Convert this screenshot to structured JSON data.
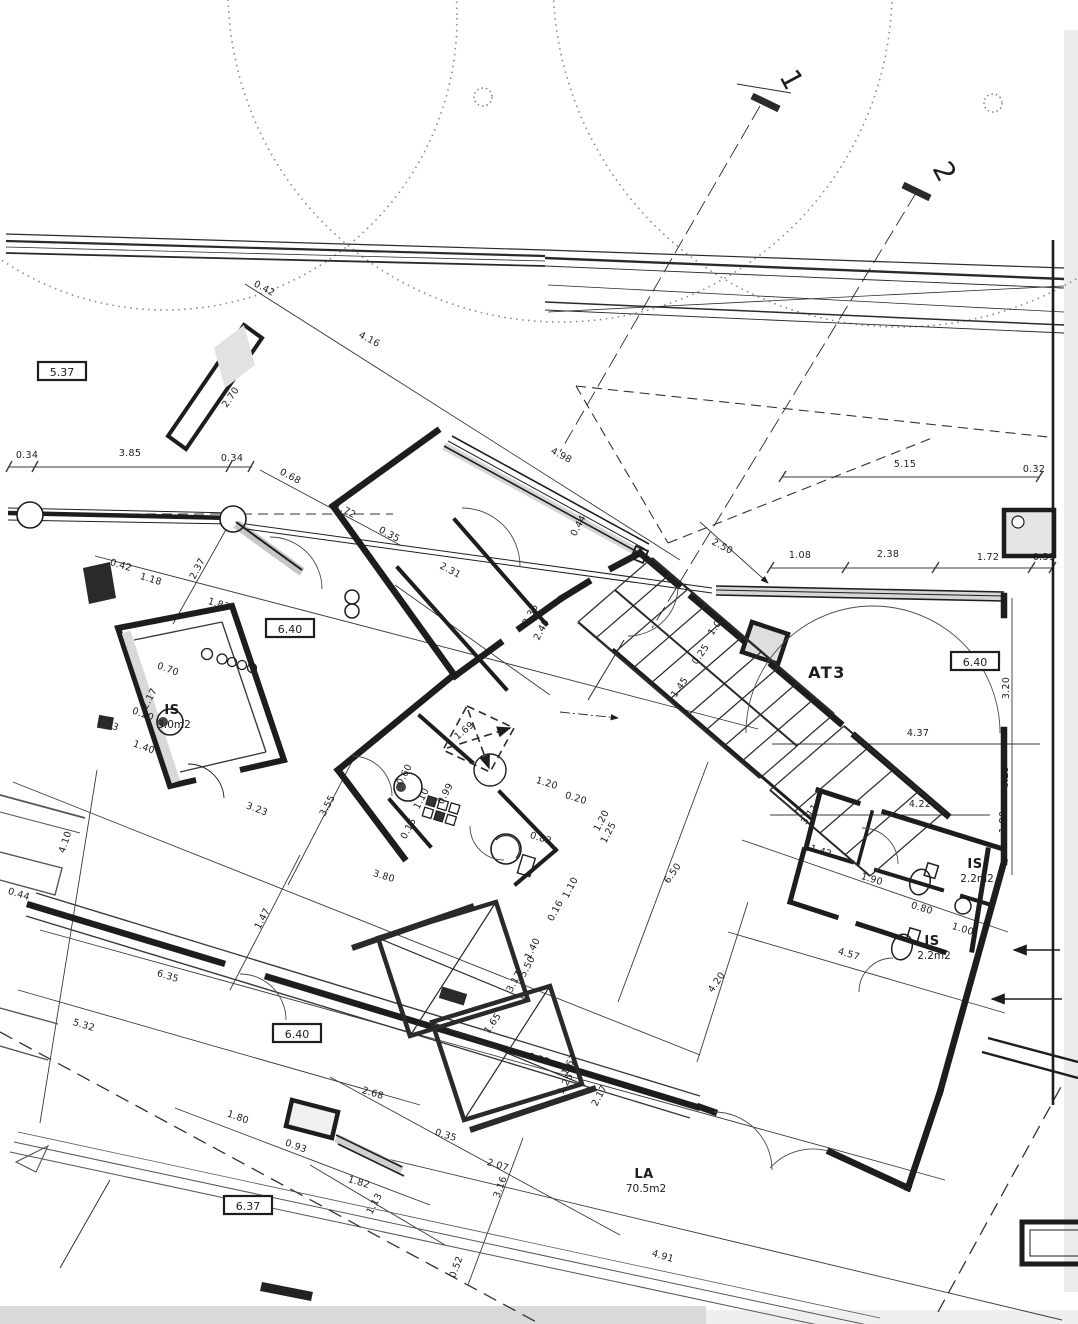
{
  "drawing": {
    "kind": "scanned architectural floor plan",
    "colors": {
      "paper": "#ffffff",
      "ink": "#1d1d1d",
      "thin_line": "#3a3a3a",
      "hatch_gray": "#dedede",
      "scan_shadow": "#e3e3e3"
    },
    "rooms": [
      {
        "name": "AT3",
        "area": "",
        "x": 827,
        "y": 678,
        "style": "big"
      },
      {
        "name": "IS",
        "area": "3.0m2",
        "x": 172,
        "y": 714,
        "style": "small"
      },
      {
        "name": "IS",
        "area": "2.2m2",
        "x": 975,
        "y": 868,
        "style": "small"
      },
      {
        "name": "IS",
        "area": "2.2m2",
        "x": 932,
        "y": 945,
        "style": "small"
      },
      {
        "name": "LA",
        "area": "70.5m2",
        "x": 644,
        "y": 1178,
        "style": "small"
      }
    ],
    "level_markers": [
      {
        "value": "5.37",
        "x": 62,
        "y": 372
      },
      {
        "value": "6.40",
        "x": 290,
        "y": 629
      },
      {
        "value": "6.40",
        "x": 975,
        "y": 662
      },
      {
        "value": "6.40",
        "x": 297,
        "y": 1034
      },
      {
        "value": "6.37",
        "x": 248,
        "y": 1206
      }
    ],
    "section_markers": [
      {
        "label": "1",
        "x": 783,
        "y": 84,
        "rot": 62
      },
      {
        "label": "2",
        "x": 936,
        "y": 176,
        "rot": 62
      }
    ],
    "dimensions": [
      {
        "t": "0.34",
        "x": 27,
        "y": 458,
        "r": 0
      },
      {
        "t": "3.85",
        "x": 130,
        "y": 456,
        "r": 0
      },
      {
        "t": "0.34",
        "x": 232,
        "y": 461,
        "r": 0
      },
      {
        "t": "2.70",
        "x": 233,
        "y": 399,
        "r": -55
      },
      {
        "t": "0.42",
        "x": 263,
        "y": 291,
        "r": 28
      },
      {
        "t": "4.16",
        "x": 368,
        "y": 342,
        "r": 28
      },
      {
        "t": "4.98",
        "x": 560,
        "y": 458,
        "r": 28
      },
      {
        "t": "0.68",
        "x": 289,
        "y": 479,
        "r": 28
      },
      {
        "t": "1.72",
        "x": 344,
        "y": 513,
        "r": 28
      },
      {
        "t": "0.35",
        "x": 388,
        "y": 537,
        "r": 28
      },
      {
        "t": "2.31",
        "x": 449,
        "y": 573,
        "r": 28
      },
      {
        "t": "5.15",
        "x": 905,
        "y": 467,
        "r": 0
      },
      {
        "t": "0.32",
        "x": 1034,
        "y": 472,
        "r": 0
      },
      {
        "t": "2.50",
        "x": 721,
        "y": 549,
        "r": 28
      },
      {
        "t": "1.08",
        "x": 800,
        "y": 558,
        "r": 0
      },
      {
        "t": "2.38",
        "x": 888,
        "y": 557,
        "r": 0
      },
      {
        "t": "1.72",
        "x": 988,
        "y": 560,
        "r": 0
      },
      {
        "t": "0.31",
        "x": 1044,
        "y": 560,
        "r": 0
      },
      {
        "t": "0.44",
        "x": 581,
        "y": 527,
        "r": -62
      },
      {
        "t": "3.36",
        "x": 533,
        "y": 616,
        "r": -62
      },
      {
        "t": "2.40",
        "x": 544,
        "y": 631,
        "r": -62
      },
      {
        "t": "1.05",
        "x": 719,
        "y": 627,
        "r": -55
      },
      {
        "t": "0.25",
        "x": 703,
        "y": 656,
        "r": -55
      },
      {
        "t": "1.45",
        "x": 682,
        "y": 689,
        "r": -55
      },
      {
        "t": "0.25",
        "x": 1008,
        "y": 777,
        "r": -90
      },
      {
        "t": "3.20",
        "x": 1009,
        "y": 688,
        "r": -90
      },
      {
        "t": "4.37",
        "x": 918,
        "y": 736,
        "r": 0
      },
      {
        "t": "3.11",
        "x": 812,
        "y": 816,
        "r": -55
      },
      {
        "t": "4.22",
        "x": 920,
        "y": 807,
        "r": 0
      },
      {
        "t": "1.80",
        "x": 1006,
        "y": 822,
        "r": -90
      },
      {
        "t": "1.42",
        "x": 820,
        "y": 854,
        "r": 17
      },
      {
        "t": "1.90",
        "x": 871,
        "y": 882,
        "r": 17
      },
      {
        "t": "0.80",
        "x": 921,
        "y": 911,
        "r": 17
      },
      {
        "t": "1.00",
        "x": 962,
        "y": 932,
        "r": 17
      },
      {
        "t": "4.57",
        "x": 848,
        "y": 957,
        "r": 17
      },
      {
        "t": "4.20",
        "x": 719,
        "y": 984,
        "r": -55
      },
      {
        "t": "6.50",
        "x": 675,
        "y": 875,
        "r": -55
      },
      {
        "t": "1.20",
        "x": 546,
        "y": 786,
        "r": 17
      },
      {
        "t": "0.20",
        "x": 575,
        "y": 801,
        "r": 17
      },
      {
        "t": "1.20",
        "x": 604,
        "y": 822,
        "r": -62
      },
      {
        "t": "1.25",
        "x": 611,
        "y": 834,
        "r": -62
      },
      {
        "t": "0.82",
        "x": 540,
        "y": 841,
        "r": 17
      },
      {
        "t": "1.10",
        "x": 424,
        "y": 800,
        "r": -62
      },
      {
        "t": "0.99",
        "x": 448,
        "y": 795,
        "r": -62
      },
      {
        "t": "0.15",
        "x": 411,
        "y": 830,
        "r": -62
      },
      {
        "t": "0.60",
        "x": 407,
        "y": 776,
        "r": -62
      },
      {
        "t": "1.10",
        "x": 573,
        "y": 889,
        "r": -62
      },
      {
        "t": "0.16",
        "x": 558,
        "y": 912,
        "r": -62
      },
      {
        "t": "3.80",
        "x": 383,
        "y": 879,
        "r": 17
      },
      {
        "t": "1.69",
        "x": 466,
        "y": 733,
        "r": -40
      },
      {
        "t": "3.17",
        "x": 517,
        "y": 983,
        "r": -62
      },
      {
        "t": "1.40",
        "x": 535,
        "y": 950,
        "r": -62
      },
      {
        "t": "5.50",
        "x": 530,
        "y": 968,
        "r": -62
      },
      {
        "t": "1.65",
        "x": 495,
        "y": 1025,
        "r": -55
      },
      {
        "t": "0.35",
        "x": 538,
        "y": 1062,
        "r": 17
      },
      {
        "t": "1.67",
        "x": 572,
        "y": 1066,
        "r": -62
      },
      {
        "t": "1.25",
        "x": 568,
        "y": 1085,
        "r": -62
      },
      {
        "t": "2.17",
        "x": 602,
        "y": 1097,
        "r": -62
      },
      {
        "t": "2.68",
        "x": 372,
        "y": 1096,
        "r": 17
      },
      {
        "t": "0.35",
        "x": 445,
        "y": 1138,
        "r": 17
      },
      {
        "t": "2.07",
        "x": 497,
        "y": 1168,
        "r": 17
      },
      {
        "t": "3.16",
        "x": 503,
        "y": 1188,
        "r": -70
      },
      {
        "t": "1.82",
        "x": 358,
        "y": 1185,
        "r": 17
      },
      {
        "t": "1.13",
        "x": 377,
        "y": 1205,
        "r": -62
      },
      {
        "t": "0.52",
        "x": 459,
        "y": 1268,
        "r": -70
      },
      {
        "t": "4.91",
        "x": 662,
        "y": 1259,
        "r": 17
      },
      {
        "t": "4.10",
        "x": 68,
        "y": 843,
        "r": -72
      },
      {
        "t": "3.23",
        "x": 256,
        "y": 812,
        "r": 20
      },
      {
        "t": "3.55",
        "x": 330,
        "y": 807,
        "r": -62
      },
      {
        "t": "1.47",
        "x": 265,
        "y": 920,
        "r": -62
      },
      {
        "t": "6.35",
        "x": 167,
        "y": 979,
        "r": 17
      },
      {
        "t": "5.32",
        "x": 83,
        "y": 1028,
        "r": 17
      },
      {
        "t": "0.44",
        "x": 18,
        "y": 897,
        "r": 17
      },
      {
        "t": "1.80",
        "x": 237,
        "y": 1120,
        "r": 20
      },
      {
        "t": "0.93",
        "x": 295,
        "y": 1149,
        "r": 20
      },
      {
        "t": "2.17",
        "x": 152,
        "y": 700,
        "r": -62
      },
      {
        "t": "0.70",
        "x": 167,
        "y": 672,
        "r": 20
      },
      {
        "t": "0.20",
        "x": 142,
        "y": 717,
        "r": 20
      },
      {
        "t": "1.40",
        "x": 143,
        "y": 750,
        "r": 20
      },
      {
        "t": "1.33",
        "x": 107,
        "y": 727,
        "r": 20
      },
      {
        "t": "0.42",
        "x": 120,
        "y": 568,
        "r": 17
      },
      {
        "t": "1.18",
        "x": 150,
        "y": 582,
        "r": 17
      },
      {
        "t": "2.37",
        "x": 200,
        "y": 570,
        "r": -62
      },
      {
        "t": "1.83",
        "x": 218,
        "y": 607,
        "r": 17
      }
    ]
  }
}
